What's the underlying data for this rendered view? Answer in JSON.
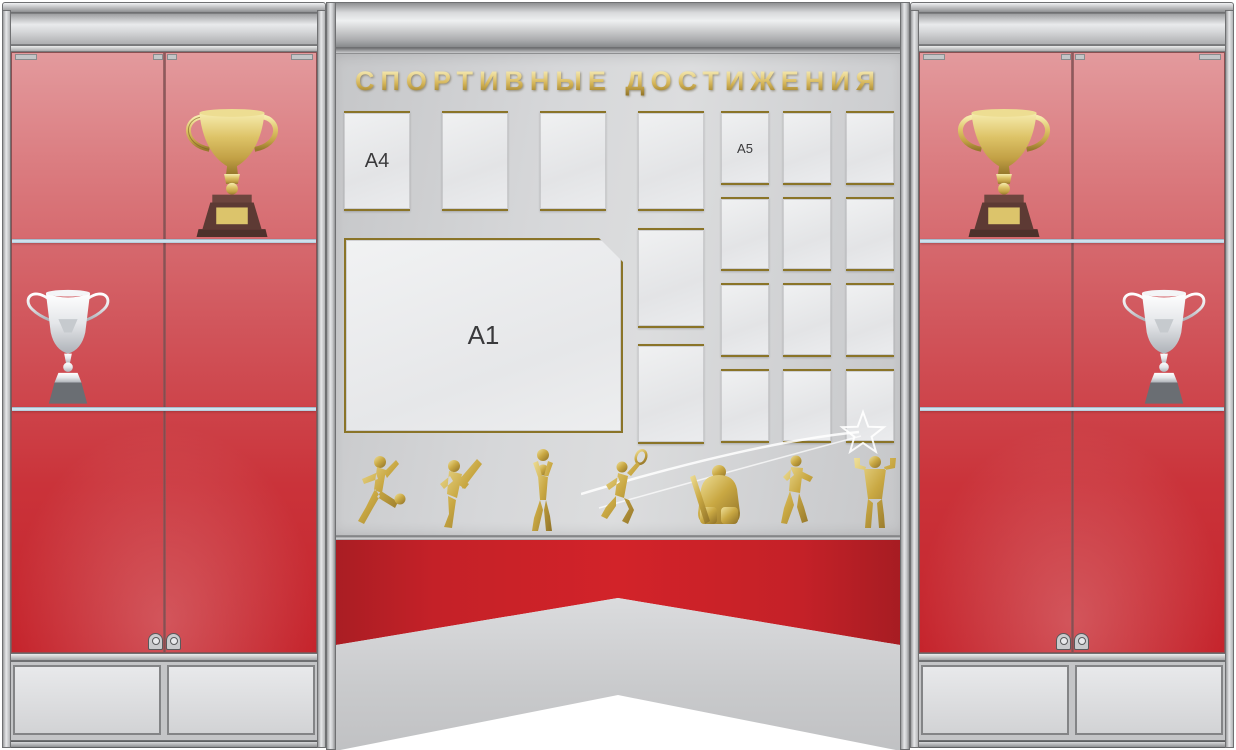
{
  "title": "СПОРТИВНЫЕ ДОСТИЖЕНИЯ",
  "board": {
    "labels": {
      "a4": "A4",
      "a1": "A1",
      "a5": "A5"
    },
    "a4_pockets_top_row": 4,
    "a4_pockets_right_column_extra": 2,
    "a5_grid": {
      "cols": 3,
      "rows": 4
    }
  },
  "silhouette_icons": [
    "football-player-icon",
    "karate-kick-icon",
    "volleyball-player-icon",
    "badminton-player-icon",
    "hockey-goalie-icon",
    "boxer-icon",
    "bodybuilder-icon"
  ],
  "cabinets": {
    "left": {
      "shelf1_item": "gold-trophy-cup",
      "shelf2_item": "silver-trophy-cup",
      "doors": 2,
      "shelves": 2
    },
    "right": {
      "shelf1_item": "gold-trophy-cup",
      "shelf2_item": "silver-trophy-cup",
      "doors": 2,
      "shelves": 2
    }
  },
  "colors": {
    "glass_red": "#c5232b",
    "banner_red": "#c42128",
    "pocket_gold_trim": "#8a7428",
    "title_gold": "#d2b254",
    "frame_gray": "#c9cacc",
    "shelf_glass_blue": "#aec7d8",
    "trophy_gold": "#ddc367",
    "trophy_silver": "#d9dce0",
    "trophy_base_brown": "#5d3a34"
  }
}
